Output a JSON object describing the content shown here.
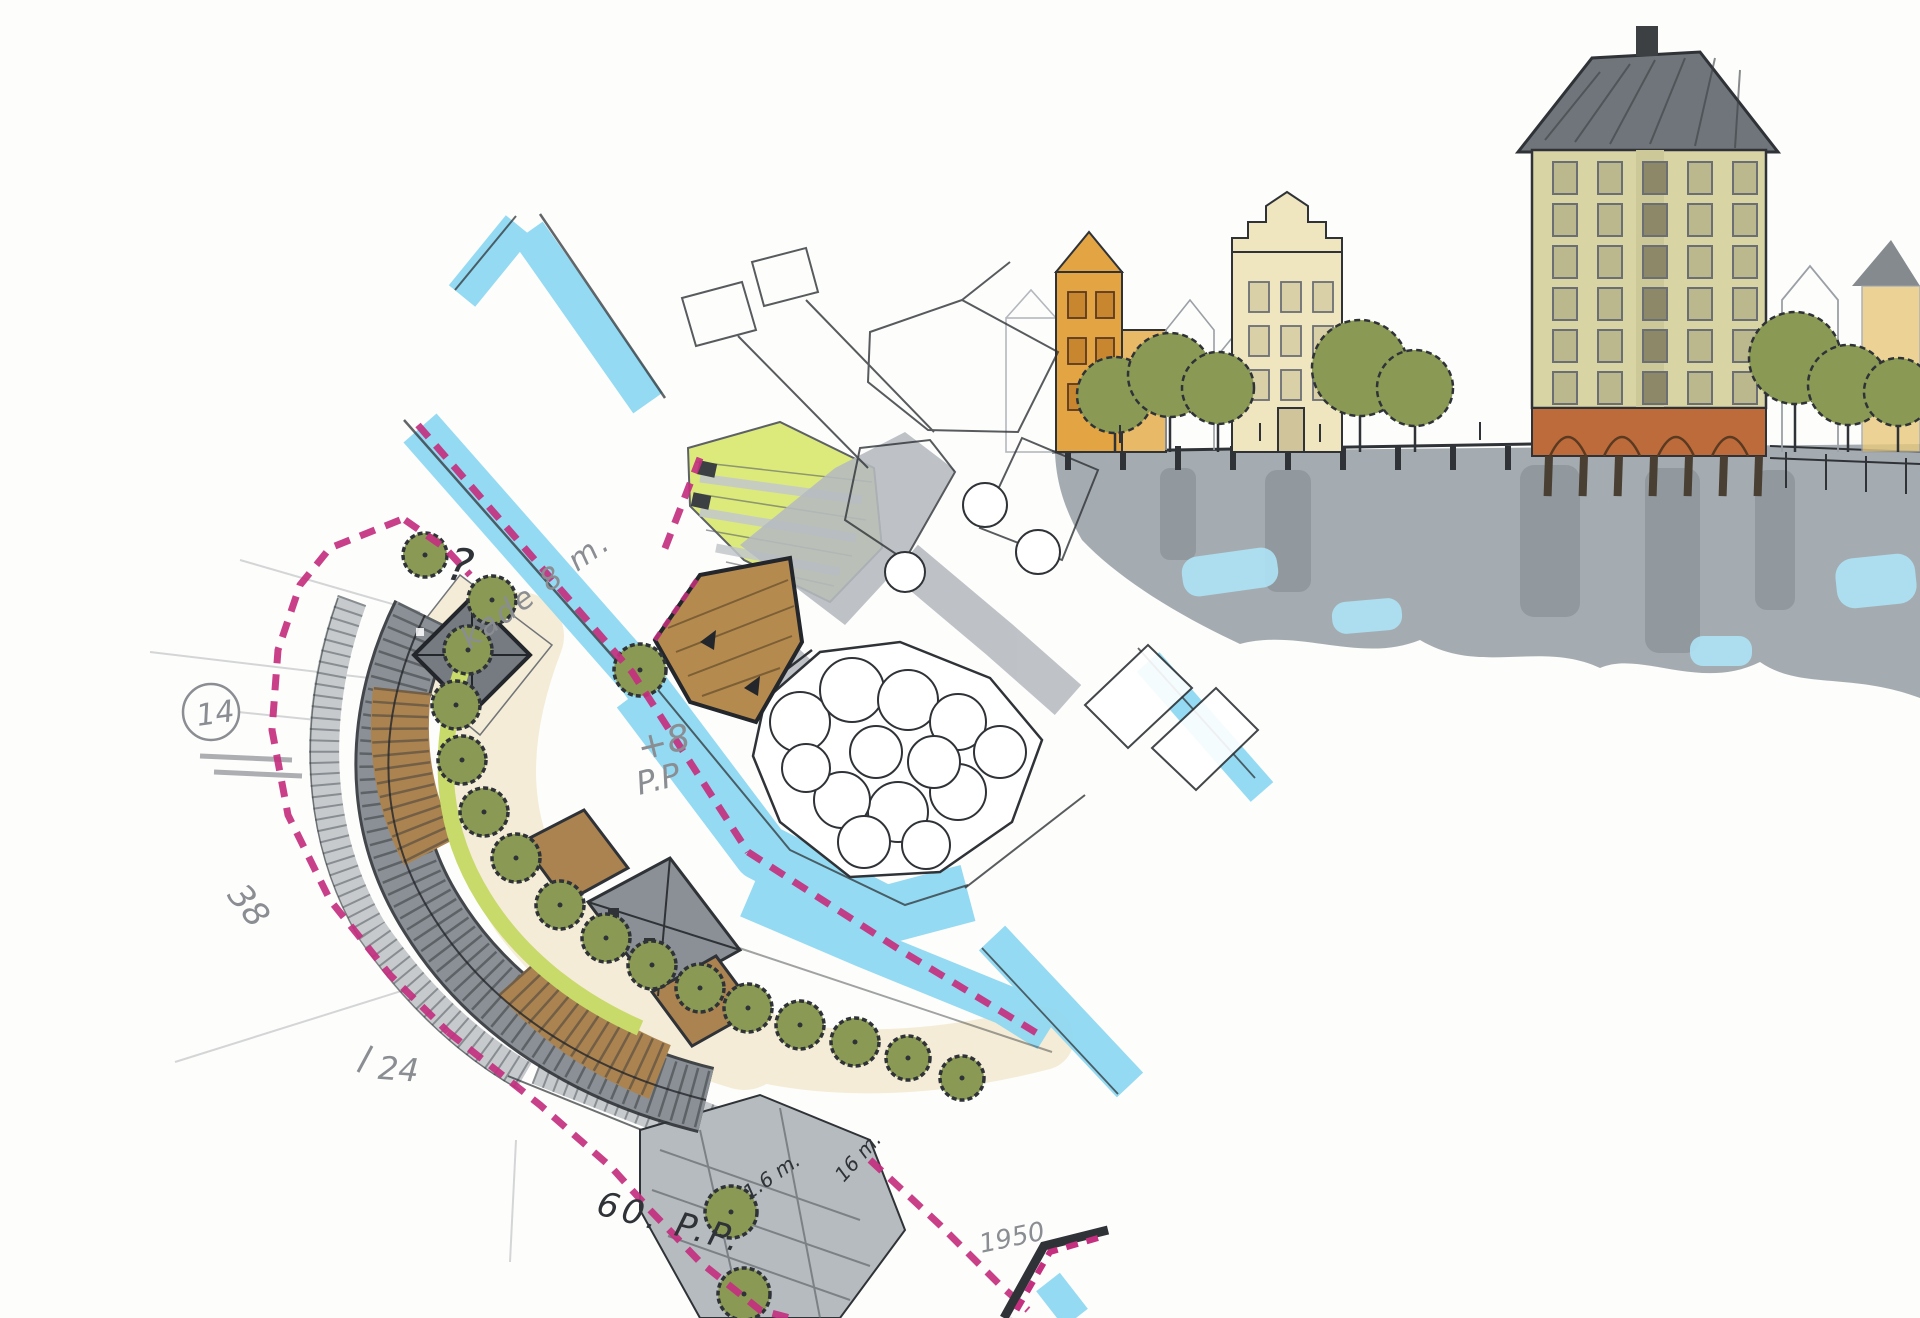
{
  "drawing": {
    "kind": "hand-drawn harbor site plan sketch with waterfront elevation",
    "annotations": {
      "ref_number": "14",
      "question_mark": "?",
      "quay_note": "kade 8 m.",
      "level_note": "+8",
      "level_note_2": "P.P",
      "count_left": "38",
      "count_bottom_left": "24",
      "parking_note": "60. P.P.",
      "dim_small": "1.6 m.",
      "dim_large": "16 m.",
      "year_note": "1950"
    }
  },
  "colors": {
    "paper": "#fdfdfb",
    "water": "#8fd8f2",
    "waterLight": "#aee4f6",
    "boundary": "#c4307f",
    "treeFill": "#8a9a55",
    "treeOutline": "#2f3337",
    "lawn": "#dcea7c",
    "gardenStrip": "#c7da6a",
    "sand": "#f4ecd6",
    "roofGray": "#8b9096",
    "roofDark": "#70757b",
    "roofBrown": "#ab8350",
    "roadGray": "#b6bbc0",
    "parkGray": "#c6cacd",
    "ink": "#2f3337",
    "pencil": "#8a8d92",
    "facadeTall": "#d8d4a4",
    "facadeCream": "#efe6c0",
    "facadeOrange": "#e3a544",
    "brick": "#bd6b3a",
    "reflection": "#99a0a6",
    "reflectionDark": "#7e858c"
  }
}
